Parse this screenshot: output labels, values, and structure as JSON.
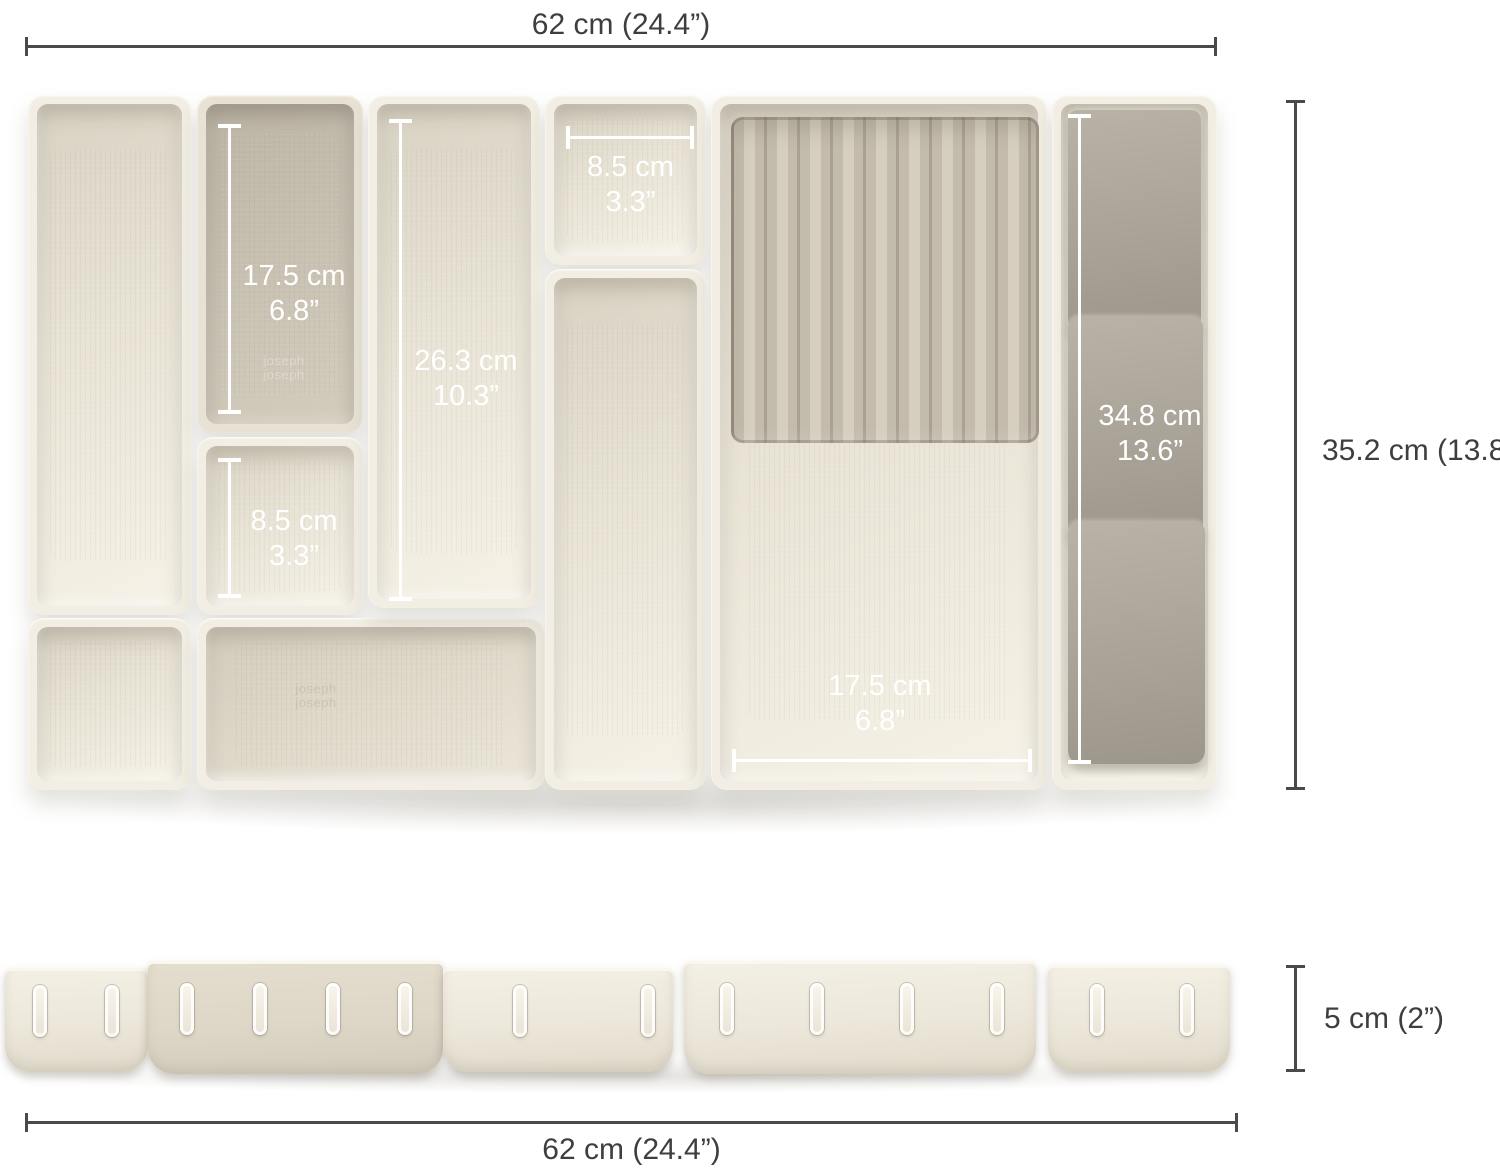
{
  "diagram": {
    "title_hidden": "",
    "overall": {
      "top_width": "62 cm (24.4”)",
      "height": "35.2 cm (13.8”)",
      "tray_depth": "5 cm (2”)",
      "bottom_width": "62 cm (24.4”)"
    },
    "compartments": {
      "divider_tray": {
        "cm": "17.5 cm",
        "inch": "6.8”"
      },
      "long_tray": {
        "cm": "26.3 cm",
        "inch": "10.3”"
      },
      "square_top": {
        "cm": "8.5 cm",
        "inch": "3.3”"
      },
      "square_left": {
        "cm": "8.5 cm",
        "inch": "3.3”"
      },
      "knife_store": {
        "cm": "34.8 cm",
        "inch": "13.6”"
      },
      "large_tray": {
        "cm": "17.5 cm",
        "inch": "6.8”"
      }
    },
    "brand_embossing": "joseph joseph",
    "colors": {
      "cream": "#f2eee3",
      "cream_interior": "#e8e3d5",
      "taupe": "#c8c1b2",
      "flap_gray": "#a8a196",
      "dimension_line": "#4a4a4a",
      "dimension_text": "#3e3e3e",
      "in_tray_line": "#ffffff",
      "background": "#ffffff"
    }
  }
}
